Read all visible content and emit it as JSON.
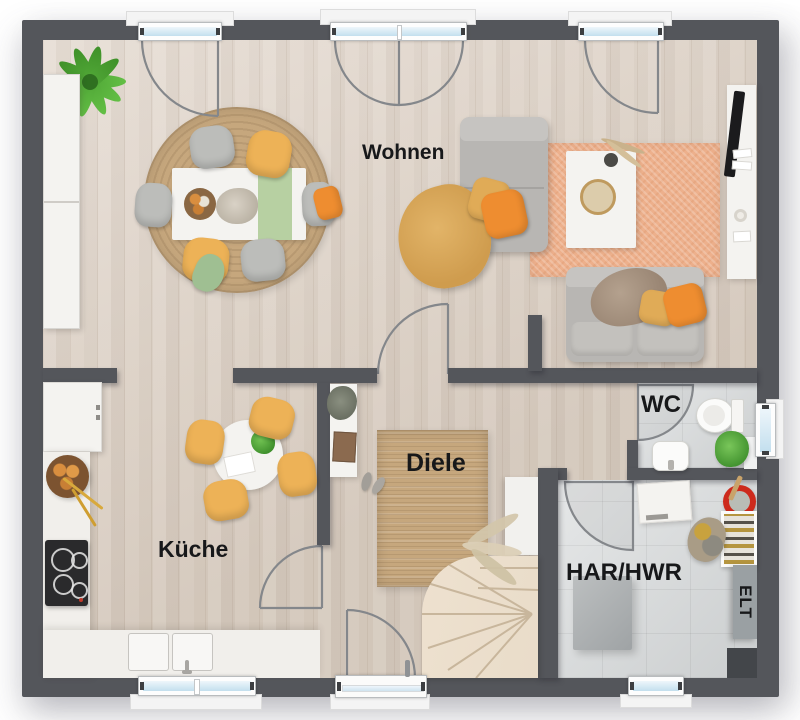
{
  "labels": {
    "wohnen": "Wohnen",
    "kueche": "Küche",
    "diele": "Diele",
    "wc": "WC",
    "har_hwr": "HAR/HWR",
    "elt": "ELT"
  },
  "colors": {
    "wall": "#54565b",
    "floor_wood": "#dccfc2",
    "floor_tile": "#d6d9da",
    "rug_jute": "#c6a77d",
    "rug_orange": "#edb08c",
    "counter_white": "#f1efeb",
    "sofa_gray": "#b8b6b3",
    "chair_orange": "#edb257",
    "pillow_orange": "#ee8d30",
    "pillow_yellow": "#e0ab57",
    "plant_green": "#5ab340",
    "glass_blue": "#c3dfee",
    "cooktop_black": "#2a2a2c",
    "basin_red": "#cd2a1c",
    "elt_gray": "#9aa0a3",
    "stairs_wood": "#e9dcc9",
    "label_ink": "#17181a"
  }
}
